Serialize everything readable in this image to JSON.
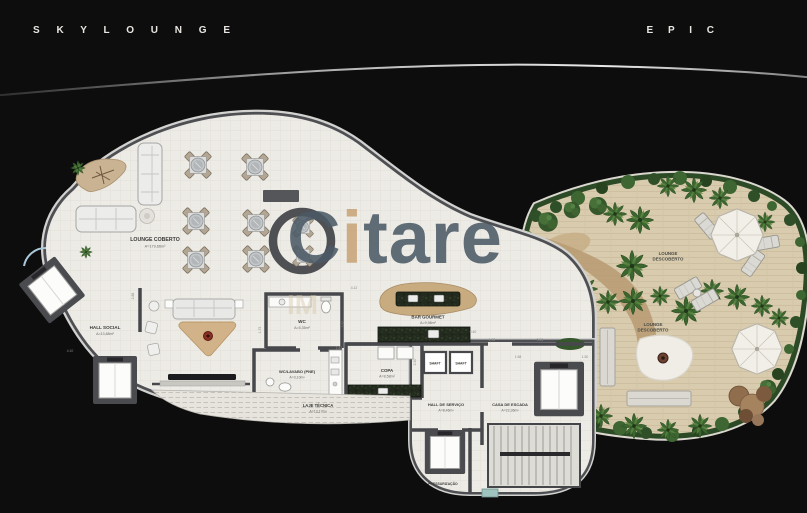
{
  "header": {
    "left_title": "S K Y L O U N G E",
    "right_title": "E P I C"
  },
  "watermark": {
    "c": "C",
    "i": "i",
    "tare": "tare",
    "sub": "IM",
    "slate_color": "#4b5a66",
    "tan_color": "#c8a478"
  },
  "rooms": {
    "lounge_coberto": {
      "label": "LOUNGE COBERTO",
      "area": "A=179,66m²"
    },
    "hall_social": {
      "label": "HALL SOCIAL",
      "area": "A=13,88m²"
    },
    "wc": {
      "label": "WC",
      "area": "A=5,35m²"
    },
    "bar_gourmet": {
      "label": "BAR GOURMET",
      "area": "A=9,98m²"
    },
    "copa": {
      "label": "COPA",
      "area": "A=8,58m²"
    },
    "wc_lavabo_pne": {
      "label": "WC/LAVABO (PNE)",
      "area": "A=3,10m²"
    },
    "laje_tecnica": {
      "label": "LAJE TÉCNICA",
      "area": "A=13,17m²"
    },
    "shaft_left": {
      "label": "SHAFT"
    },
    "shaft_right": {
      "label": "SHAFT"
    },
    "hall_servico": {
      "label": "HALL DE SERVIÇO",
      "area": "A=8,46m²"
    },
    "casa_escada": {
      "label": "CASA DE ESCADA",
      "area": "A=22,36m²"
    },
    "pressurizacao": {
      "label": "PRESSURIZAÇÃO"
    },
    "lounge_descoberto_upper": {
      "line1": "LOUNGE",
      "line2": "DESCOBERTO"
    },
    "lounge_descoberto_lower": {
      "line1": "LOUNGE",
      "line2": "DESCOBERTO"
    }
  },
  "dimensions": [
    "2.88",
    "4.10",
    "1.73",
    "3.50",
    "1.43",
    "4.12",
    "0.40",
    "1.38",
    "5.26",
    "1.58",
    "1.50",
    "2.30"
  ]
}
